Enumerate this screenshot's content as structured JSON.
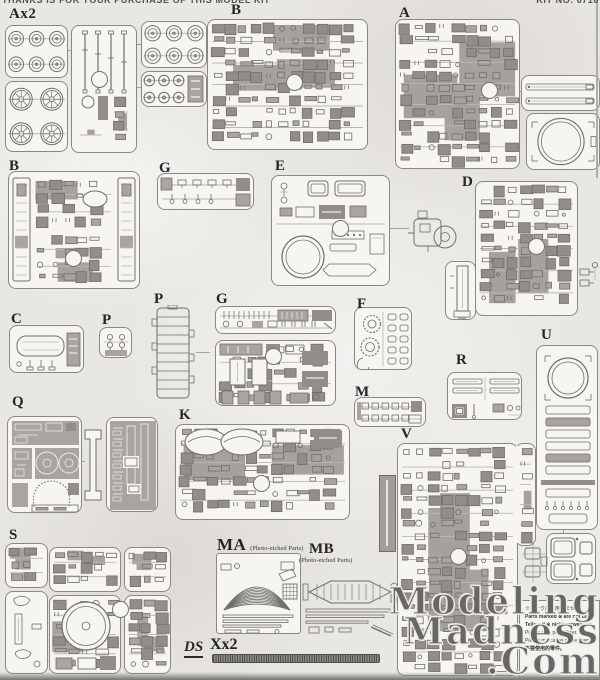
{
  "header": {
    "left_text": "THANKS IS FOR YOUR PURCHASE OF THIS MODEL KIT",
    "right_text": "KIT NO. 6716"
  },
  "sprues": [
    {
      "id": "ax2",
      "label": "Ax2"
    },
    {
      "id": "b-top",
      "label": "B"
    },
    {
      "id": "a",
      "label": "A"
    },
    {
      "id": "b-mid",
      "label": "B"
    },
    {
      "id": "g-small",
      "label": "G"
    },
    {
      "id": "e",
      "label": "E"
    },
    {
      "id": "d",
      "label": "D"
    },
    {
      "id": "c",
      "label": "C"
    },
    {
      "id": "p-small",
      "label": "P"
    },
    {
      "id": "p-tall",
      "label": "P"
    },
    {
      "id": "g-big",
      "label": "G"
    },
    {
      "id": "f",
      "label": "F"
    },
    {
      "id": "m",
      "label": "M"
    },
    {
      "id": "r",
      "label": "R"
    },
    {
      "id": "u",
      "label": "U"
    },
    {
      "id": "q",
      "label": "Q"
    },
    {
      "id": "k",
      "label": "K"
    },
    {
      "id": "v",
      "label": "V"
    },
    {
      "id": "s",
      "label": "S"
    },
    {
      "id": "ma",
      "label": "MA",
      "subtitle": "(Photo-etched Parts)"
    },
    {
      "id": "mb",
      "label": "MB",
      "subtitle": "(Photo-etched Parts)"
    },
    {
      "id": "ds",
      "label": "DS"
    },
    {
      "id": "x",
      "label": "Xx2"
    }
  ],
  "note_box": {
    "lines": [
      "※マークは使用しません。",
      "Parts marked ※ are not used.",
      "Teile mit ※ nicht verwenden.",
      "Pièces à ne pas utiliser.",
      "Piezas marcadas no se usan.",
      "不要使用的零件。"
    ]
  },
  "watermark": {
    "line1": "Modeling",
    "line2": "Madness",
    "line3": ".Com"
  },
  "colors": {
    "paper": "#e9e7e2",
    "box_bg": "#f6f5f1",
    "line": "#706e69",
    "part_fill": "#a8a5a0",
    "watermark": "#5a5855"
  }
}
